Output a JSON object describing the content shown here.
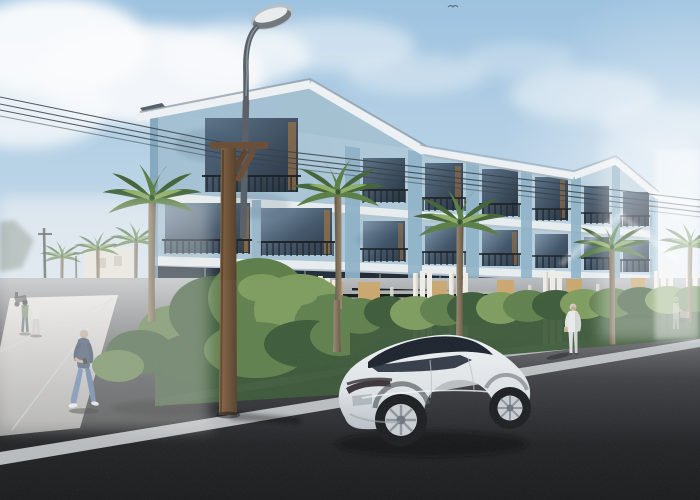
{
  "scene": {
    "title": "Street-level architectural rendering: three-story light-blue townhouse complex with palm trees, street lamp, pedestrians and a white SUV",
    "setting": "sunny day, hazy bright sky with soft clouds, dark asphalt street in foreground",
    "objects": [
      {
        "name": "apartment-building",
        "description": "long 3-story light blue facade, white floor bands, gable roofs at both ends, dark glass windows with black juliet railings"
      },
      {
        "name": "hedge-row",
        "description": "green shrub hedge along the front fence, taller bush mass at the street corner"
      },
      {
        "name": "fence",
        "description": "black horizontal-slat fence with plywood gate doors and clusters of square white gate pillars"
      },
      {
        "name": "palm-trees",
        "description": "six foreground palms along the facade plus a hazy row of background palms receding left"
      },
      {
        "name": "street-lamp",
        "description": "tall gray cobra-head street light rising beside a brown wooden utility pole with cross-arm"
      },
      {
        "name": "power-lines",
        "description": "four thin wires crossing the whole scene diagonally"
      },
      {
        "name": "car",
        "description": "white/silver electric SUV (Model-Y-like), rear three-quarter view, dark glass canopy, silver multi-spoke wheels"
      },
      {
        "name": "walking-man",
        "description": "gray-haired man in navy jacket, blue jeans and white sneakers looking at his phone"
      },
      {
        "name": "standing-person",
        "description": "person dressed in white standing on the sidewalk by the hedge"
      },
      {
        "name": "distant-couple",
        "description": "two hazy pedestrians walking on the side street at far left"
      },
      {
        "name": "hazy-stroller-person",
        "description": "washed-out figure with a pink stroller at the far right"
      },
      {
        "name": "parked-scooter",
        "description": "small dark scooter at the far-left road edge"
      },
      {
        "name": "road-markings",
        "description": "white lane line crossing the foreground diagonally, light gray curb strip along the hedge"
      },
      {
        "name": "bird",
        "description": "tiny bird high in the sky"
      }
    ],
    "counts": {
      "building_floors": 3,
      "window_bays_visible": 8,
      "foreground_palm_trees": 6,
      "background_palm_trees": 4,
      "pedestrians": 5,
      "vehicles": 1,
      "street_lamps": 1,
      "utility_poles": 3,
      "power_lines": 4
    }
  },
  "palette": {
    "sky-top": "#9ec3e0",
    "sky-mid": "#c9dcea",
    "sky-horizon": "#e9edf0",
    "cloud-white": "#fbfcfd",
    "wall-main": "#a3c0d2",
    "wall-light": "#c0d4e0",
    "wall-shade": "#a3bfd1",
    "pilaster": "#8fb2c7",
    "trim-white": "#e7ecee",
    "fascia": "#eef1f3",
    "glass-dark": "#2e3c4b",
    "glass-light": "#7e95aa",
    "wood-frame": "#9a7347",
    "railing-dark": "#1c2125",
    "hedge-dark": "#3c5a38",
    "hedge-mid": "#5f7f4c",
    "hedge-light": "#7d9c5e",
    "door-wood": "#c9a76e",
    "pillar-white": "#efece4",
    "fence-black": "#15181a",
    "palm-green-dark": "#46663c",
    "palm-green-mid": "#5d8048",
    "palm-green-light": "#8fae69",
    "palm-trunk": "#8a7a64",
    "pole-wood": "#7a5b3e",
    "lamp-metal": "#5a6168",
    "road-dark": "#191a1b",
    "curb-gray": "#b4b8b9",
    "lane-line": "#ccd0d1",
    "wire-dark": "#3a4148",
    "car-body": "#eef1f3",
    "car-glass": "#1b222c",
    "haze-white": "#f4f3f0",
    "jacket-navy": "#3d4f68",
    "denim-blue": "#5b7aa6"
  }
}
